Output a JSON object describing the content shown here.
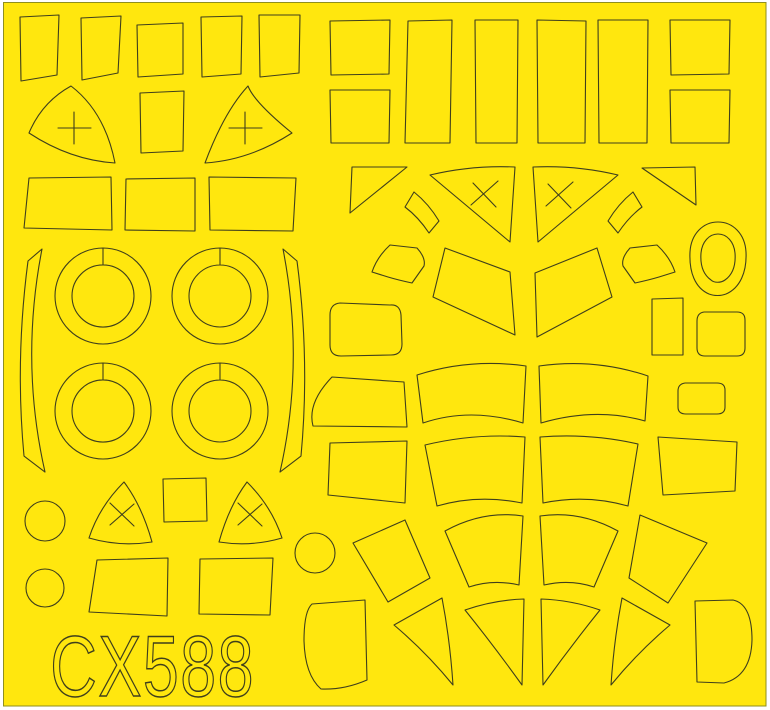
{
  "sheet": {
    "code": "CX588",
    "colors": {
      "background": "#ffffff",
      "sheet_yellow": "#ffe70e",
      "sheet_edge": "#8f8f1f",
      "cut_line": "#3f3f1c"
    },
    "shapes": [
      {
        "name": "mask-rect-row1-1",
        "d": "M20,17 L59,15 L57,75 L21,81 Z"
      },
      {
        "name": "mask-rect-row1-2",
        "d": "M81,18 L121,16 L118,73 L82,80 Z"
      },
      {
        "name": "mask-rect-row1-3",
        "d": "M137,25 L183,23 L183,74 L138,77 Z"
      },
      {
        "name": "mask-rect-row1-4",
        "d": "M201,17 L242,16 L241,74 L202,77 Z"
      },
      {
        "name": "mask-rect-row1-5",
        "d": "M259,15 L300,15 L299,73 L260,77 Z"
      },
      {
        "name": "mask-nose-triangle-cross-left",
        "d": "M71,86 Q105,112 115,163 Q70,160 29,133 Q42,102 71,86 Z M58,128 L91,128 M74,112 L74,144"
      },
      {
        "name": "mask-rect-row2-center",
        "d": "M140,93 L184,91 L183,151 L141,153 Z"
      },
      {
        "name": "mask-nose-triangle-cross-right",
        "d": "M248,86 Q254,102 292,133 Q250,160 205,163 Q224,112 248,86 Z M229,128 L262,128 M245,112 L245,144"
      },
      {
        "name": "mask-trapezoid-row3-1",
        "d": "M29,178 L111,177 L112,230 L24,228 Z"
      },
      {
        "name": "mask-trapezoid-row3-2",
        "d": "M126,179 L195,178 L195,231 L125,230 Z"
      },
      {
        "name": "mask-trapezoid-row3-3",
        "d": "M209,177 L296,178 L293,231 L210,230 Z"
      },
      {
        "name": "mask-crescent-strip-left",
        "d": "M28,261 Q15,360 24,456 L45,472 Q20,362 42,249 Z"
      },
      {
        "name": "mask-crescent-strip-right",
        "d": "M297,261 Q310,360 301,456 L280,472 Q305,362 283,249 Z"
      },
      {
        "name": "mask-wheel-ring-1",
        "d": "M55,296 A48,48 0 1 0 151,296 A48,48 0 1 0 55,296 Z M72,296 A31,31 0 1 0 134,296 A31,31 0 1 0 72,296 Z M103,248 L103,265"
      },
      {
        "name": "mask-wheel-ring-2",
        "d": "M172,296 A48,48 0 1 0 268,296 A48,48 0 1 0 172,296 Z M189,296 A31,31 0 1 0 251,296 A31,31 0 1 0 189,296 Z M220,248 L220,265"
      },
      {
        "name": "mask-wheel-ring-3",
        "d": "M55,411 A48,48 0 1 0 151,411 A48,48 0 1 0 55,411 Z M72,411 A31,31 0 1 0 134,411 A31,31 0 1 0 72,411 Z M103,363 L103,380"
      },
      {
        "name": "mask-wheel-ring-4",
        "d": "M172,411 A48,48 0 1 0 268,411 A48,48 0 1 0 172,411 Z M189,411 A31,31 0 1 0 251,411 A31,31 0 1 0 189,411 Z M220,363 L220,380"
      },
      {
        "name": "mask-small-circle-1",
        "d": "M25,521 A20,20 0 1 0 65,521 A20,20 0 1 0 25,521 Z"
      },
      {
        "name": "mask-triangle-x-left",
        "d": "M124,482 Q142,506 152,542 Q120,547 89,538 Q99,507 124,482 Z M110,503 L134,526 M134,504 L110,525"
      },
      {
        "name": "mask-square-center",
        "d": "M163,479 L206,478 L207,521 L164,522 Z"
      },
      {
        "name": "mask-triangle-x-right",
        "d": "M247,482 Q229,506 219,542 Q251,547 282,538 Q272,507 247,482 Z M238,503 L262,526 M262,504 L238,525"
      },
      {
        "name": "mask-small-circle-2",
        "d": "M26,588 A19,19 0 1 0 64,588 A19,19 0 1 0 26,588 Z"
      },
      {
        "name": "mask-small-circle-3",
        "d": "M295,553 A20,20 0 1 0 335,553 A20,20 0 1 0 295,553 Z"
      },
      {
        "name": "mask-trapezoid-bottom-1",
        "d": "M97,560 L168,558 L167,616 L89,612 Z"
      },
      {
        "name": "mask-trapezoid-bottom-2",
        "d": "M200,559 L273,558 L270,615 L199,614 Z"
      },
      {
        "name": "mask-square-topright-1",
        "d": "M330,21 L390,20 L389,74 L331,75 Z"
      },
      {
        "name": "mask-square-topright-2",
        "d": "M330,90 L390,90 L389,143 L331,143 Z"
      },
      {
        "name": "mask-tall-rect-1",
        "d": "M408,21 L452,20 L450,143 L405,143 Z"
      },
      {
        "name": "mask-tall-rect-2",
        "d": "M475,20 L518,20 L517,143 L476,143 Z"
      },
      {
        "name": "mask-tall-rect-3",
        "d": "M537,20 L586,21 L585,143 L538,143 Z"
      },
      {
        "name": "mask-tall-rect-4",
        "d": "M598,20 L648,20 L647,143 L599,143 Z"
      },
      {
        "name": "mask-square-topright-3",
        "d": "M670,20 L730,20 L729,74 L671,75 Z"
      },
      {
        "name": "mask-square-topright-4",
        "d": "M670,90 L730,90 L729,143 L671,143 Z"
      },
      {
        "name": "mask-corner-triangle-left",
        "d": "M352,167 L407,167 L350,213 Z"
      },
      {
        "name": "mask-curved-band-small-left",
        "d": "M414,192 C424,200 433,211 439,221 L429,233 C421,221 413,213 405,207 Z"
      },
      {
        "name": "mask-canopy-triangle-x-left",
        "d": "M430,175 Q472,165 515,167 L510,242 Z M473,183 L496,207 M498,181 L471,205"
      },
      {
        "name": "mask-canopy-triangle-x-right",
        "d": "M618,175 Q576,165 533,167 L538,242 Z M548,184 L571,208 M573,182 L546,206"
      },
      {
        "name": "mask-curved-band-small-right",
        "d": "M633,192 C623,200 614,211 608,221 L618,233 C626,221 634,213 642,207 Z"
      },
      {
        "name": "mask-corner-triangle-right",
        "d": "M642,168 L695,167 L696,205 Z"
      },
      {
        "name": "mask-pentagon-left",
        "d": "M390,245 L417,248 Q426,258 424,266 L412,283 Q398,280 388,277 L372,272 Q377,257 390,245 Z"
      },
      {
        "name": "mask-center-panel-left",
        "d": "M445,248 L510,272 L515,335 L433,297 Z"
      },
      {
        "name": "mask-center-panel-right",
        "d": "M535,273 L597,248 L612,297 L537,337 Z"
      },
      {
        "name": "mask-pentagon-right",
        "d": "M657,245 L630,248 Q621,258 623,266 L635,283 Q649,280 659,277 L675,272 Q670,257 657,245 Z"
      },
      {
        "name": "mask-teardrop-ring",
        "d": "M718,222 C733,222 745,234 746,252 C747,272 740,288 726,294 C721,296 714,296 709,294 C695,288 689,272 690,252 C691,234 703,222 718,222 Z M718,234 C727,234 734,242 735,253 C736,266 732,275 725,280 C721,283 714,283 711,280 C704,275 700,266 701,253 C702,242 709,234 718,234 Z"
      },
      {
        "name": "mask-rounded-quad-left",
        "d": "M340,303 Q330,304 330,315 L330,345 Q330,356 341,356 L391,355 Q402,355 402,344 L401,315 Q400,304 390,305 Z"
      },
      {
        "name": "mask-vertical-rect-right",
        "d": "M652,299 L683,298 L683,355 L652,355 Z"
      },
      {
        "name": "mask-rounded-square-right",
        "d": "M704,312 Q697,313 697,321 L697,348 Q697,356 705,356 L737,356 Q745,356 745,348 L745,320 Q745,312 737,312 Z"
      },
      {
        "name": "mask-tapered-quad-row2-left",
        "d": "M332,377 L404,382 L407,427 L313,426 Q307,403 332,377 Z"
      },
      {
        "name": "mask-arched-band-row2-left",
        "d": "M417,375 Q470,358 526,366 L523,423 Q470,407 423,423 Z"
      },
      {
        "name": "mask-arched-band-row2-right",
        "d": "M539,366 Q595,358 648,376 L645,421 Q596,407 541,423 Z"
      },
      {
        "name": "mask-small-rounded-rect-right",
        "d": "M685,383 Q678,384 678,391 L678,407 Q678,414 686,414 L717,414 Q725,414 725,407 L725,390 Q725,383 717,383 Z"
      },
      {
        "name": "mask-quad-row3-left",
        "d": "M330,443 L407,441 L405,503 L328,495 Z"
      },
      {
        "name": "mask-arched-band-row3-left",
        "d": "M425,445 Q475,433 525,437 L522,503 Q478,494 437,506 Z"
      },
      {
        "name": "mask-arched-band-row3-right",
        "d": "M540,437 Q590,433 638,444 L628,506 Q586,494 543,503 Z"
      },
      {
        "name": "mask-quad-row3-right",
        "d": "M658,437 L737,442 L735,491 L663,495 Z"
      },
      {
        "name": "mask-tilted-panel-row4-left",
        "d": "M405,520 L430,578 L388,602 L353,543 Z"
      },
      {
        "name": "mask-panel-row4-centerleft",
        "d": "M445,531 Q483,510 523,516 L519,585 Q493,579 469,587 Z"
      },
      {
        "name": "mask-panel-row4-centerright",
        "d": "M618,531 Q580,510 540,516 L544,585 Q570,579 594,587 Z"
      },
      {
        "name": "mask-tilted-panel-row4-right",
        "d": "M640,515 L707,543 L668,603 L629,578 Z"
      },
      {
        "name": "mask-rounded-panel-bottom-left",
        "d": "M312,604 L365,600 L367,680 Q344,690 321,689 Q305,675 304,641 Q304,611 312,604 Z"
      },
      {
        "name": "mask-wedge-bottom-1",
        "d": "M442,598 Q450,640 453,685 Q426,652 394,625 Z"
      },
      {
        "name": "mask-wedge-bottom-2",
        "d": "M465,610 Q494,600 524,599 L522,685 Q494,646 465,610 Z"
      },
      {
        "name": "mask-wedge-bottom-3",
        "d": "M600,610 Q571,600 541,599 L543,685 Q571,646 600,610 Z"
      },
      {
        "name": "mask-wedge-bottom-4",
        "d": "M622,598 Q614,640 611,685 Q638,652 670,625 Z"
      },
      {
        "name": "mask-d-shape-bottom-right",
        "d": "M695,601 L733,600 Q752,604 752,640 Q751,676 724,683 L697,682 Z"
      }
    ]
  }
}
